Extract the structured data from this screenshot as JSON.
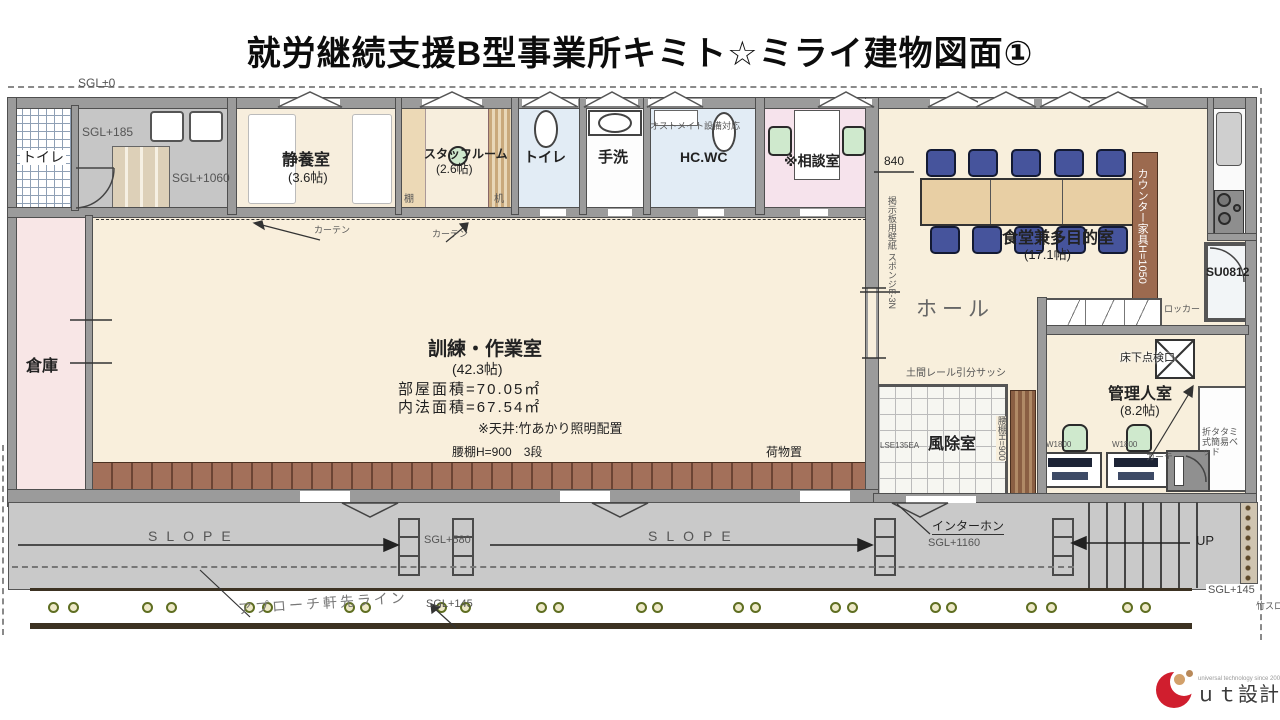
{
  "title": "就労継続支援B型事業所キミト☆ミライ建物図面①",
  "rooms": {
    "toilet_left": "トイレ",
    "rest": {
      "name": "静養室",
      "size": "(3.6帖)"
    },
    "staff": {
      "name": "スタッフルーム",
      "size": "(2.6帖)"
    },
    "toilet_mid": "トイレ",
    "handwash": "手洗",
    "hcwc": "HC.WC",
    "consult": "※相談室",
    "storage": "倉庫",
    "training": {
      "name": "訓練・作業室",
      "size": "(42.3帖)",
      "area_room": "部屋面積=70.05㎡",
      "area_inner": "内法面積=67.54㎡",
      "ceiling_note": "※天井:竹あかり照明配置"
    },
    "dining": {
      "name": "食堂兼多目的室",
      "size": "(17.1帖)"
    },
    "hall": "ホール",
    "windbreak": "風除室",
    "caretaker": {
      "name": "管理人室",
      "size": "(8.2帖)"
    }
  },
  "annotations": {
    "sgl_zero": "SGL±0",
    "sgl_185": "SGL+185",
    "sgl_1060": "SGL+1060",
    "shelf": "棚",
    "desk": "机",
    "curtain": "カーテン",
    "ostomate": "オストメイト設備対応",
    "dim_840": "840",
    "wall_note": "掲示板用壁紙 スポンジE-3N",
    "counter": "カウンター家具H=1050",
    "su0812": "SU0812",
    "locker": "ロッカー",
    "floor_hatch": "床下点検口",
    "desk_w1": "W1800",
    "desk_w2": "W1800",
    "folding_bed": "折タタミ式簡易ベッド",
    "lse": "LSE135EA",
    "waist_shelf_v": "腰棚H=900",
    "doma_sash": "土間レール引分サッシ",
    "waist_shelf": "腰棚H=900　3段",
    "luggage": "荷物置",
    "slope1": "SLOPE",
    "slope2": "SLOPE",
    "sgl_580": "SGL+580",
    "intercom": "インターホン",
    "sgl_1160": "SGL+1160",
    "up": "UP",
    "sgl_145_walk": "SGL+145",
    "sgl_145_right": "SGL+145",
    "approach": "アプローチ軒先ライン",
    "bamboo": "竹スロープ"
  },
  "logo": {
    "tagline": "universal technology since 2001",
    "name": "ｕｔ設計"
  },
  "colors": {
    "cream": "#f8efdc",
    "pink": "#f8e6e6",
    "blue_room": "#e2ecf5",
    "wall": "#9b9b9b",
    "wood": "#e6cda6",
    "counter_brown": "#9c6a4f",
    "shelf_brown": "#a3705a",
    "chair_blue": "#46549c",
    "chair_green": "#cfe9cd",
    "slope_grey": "#c9c9c9",
    "logo_red": "#d01e2e"
  }
}
